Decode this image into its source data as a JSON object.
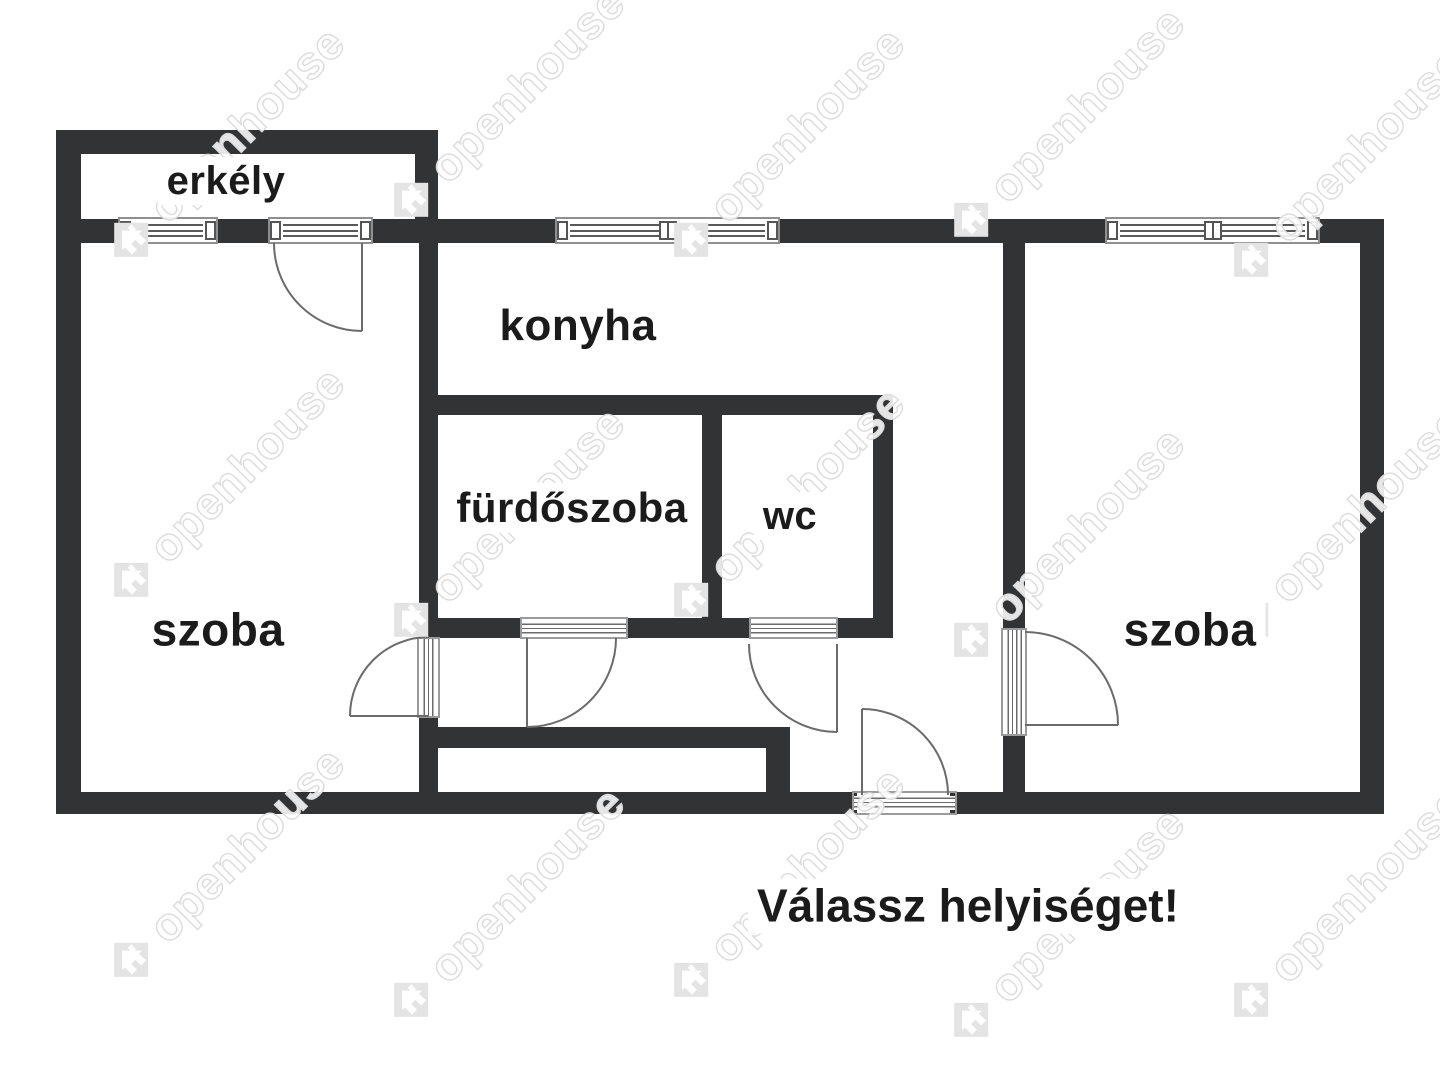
{
  "app": {
    "type": "floor-plan-viewer"
  },
  "prompt": {
    "text": "Válassz helyiséget!"
  },
  "watermark": {
    "text": "openhouse"
  },
  "rooms": [
    {
      "id": "erkely",
      "label": "erkély"
    },
    {
      "id": "konyha",
      "label": "konyha"
    },
    {
      "id": "furdoszoba",
      "label": "fürdőszoba"
    },
    {
      "id": "wc",
      "label": "wc"
    },
    {
      "id": "szoba-bal",
      "label": "szoba"
    },
    {
      "id": "szoba-jobb",
      "label": "szoba"
    }
  ],
  "features": {
    "windows": 4,
    "doors": [
      "balcony-door",
      "left-room-door",
      "bathroom-door",
      "wc-door",
      "entry-door",
      "right-room-door"
    ]
  },
  "colors": {
    "background": "#ffffff",
    "wall": "#323335",
    "door_line": "#6b6b6b",
    "window_frame": "#8f8f8f",
    "label_text": "#1b1b1b",
    "watermark": "#dcdcdc"
  }
}
